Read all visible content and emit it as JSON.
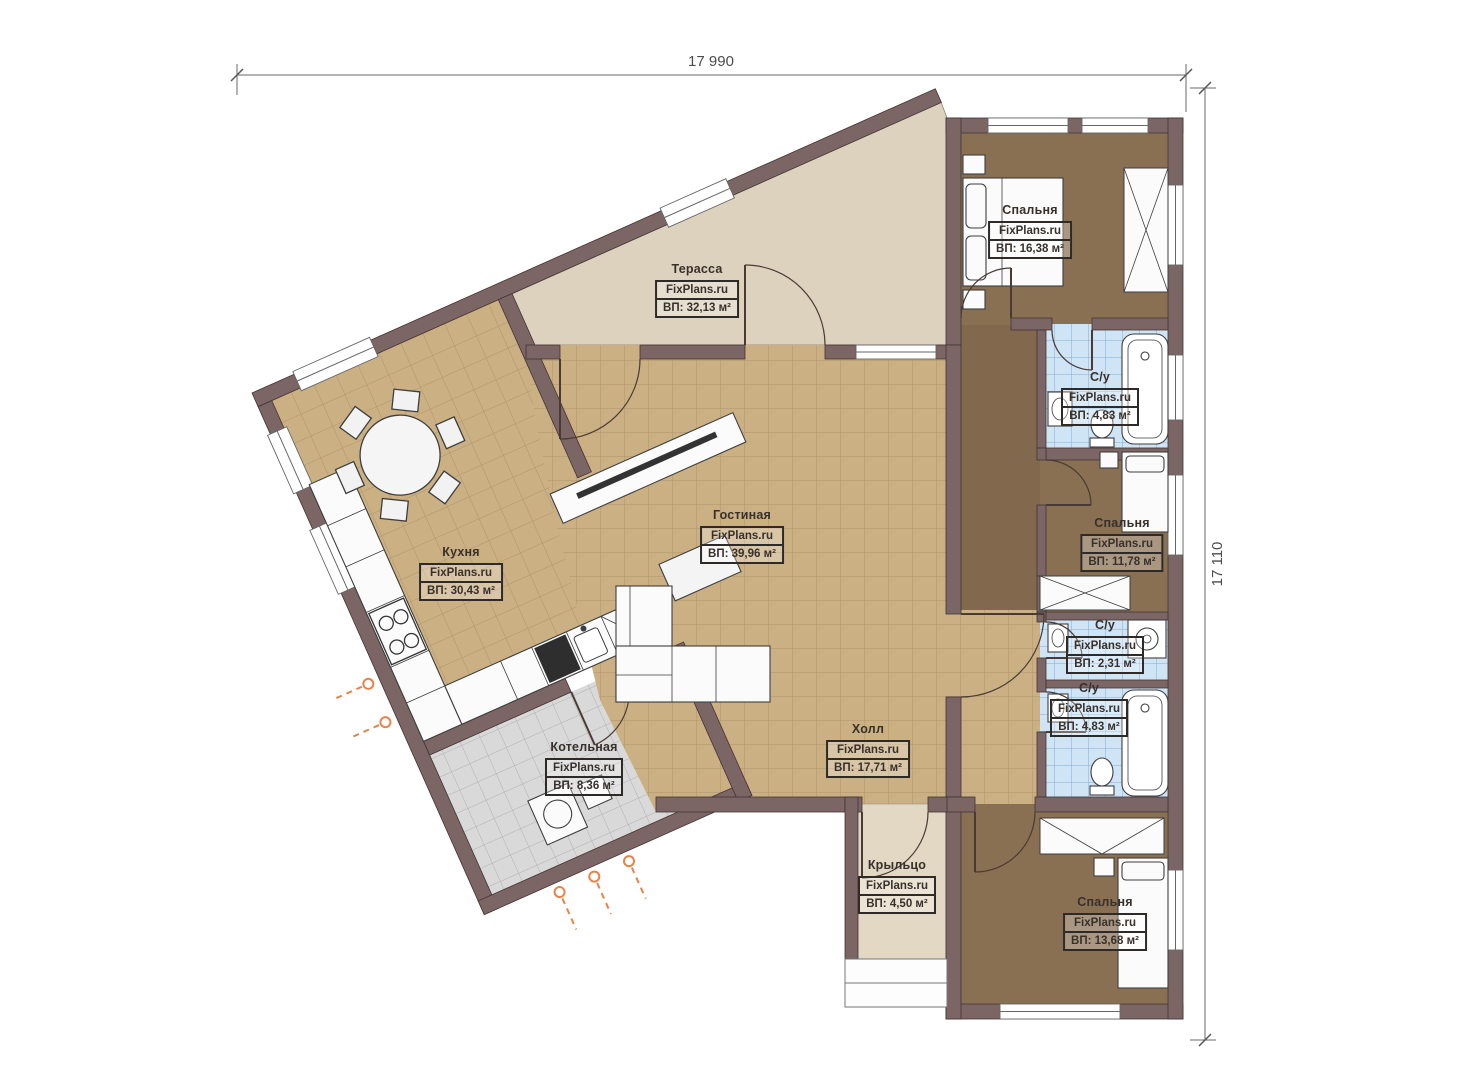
{
  "watermark": "FixPlans.ru",
  "dimensions": {
    "top": "17 990",
    "right": "17 110"
  },
  "rooms": [
    {
      "key": "terrace",
      "name": "Терасса",
      "brand": "FixPlans.ru",
      "area": "ВП: 32,13 м²"
    },
    {
      "key": "kitchen",
      "name": "Кухня",
      "brand": "FixPlans.ru",
      "area": "ВП: 30,43 м²"
    },
    {
      "key": "living-room",
      "name": "Гостиная",
      "brand": "FixPlans.ru",
      "area": "ВП: 39,96 м²"
    },
    {
      "key": "hall",
      "name": "Холл",
      "brand": "FixPlans.ru",
      "area": "ВП: 17,71 м²"
    },
    {
      "key": "boiler-room",
      "name": "Котельная",
      "brand": "FixPlans.ru",
      "area": "ВП: 8,36 м²"
    },
    {
      "key": "porch",
      "name": "Крыльцо",
      "brand": "FixPlans.ru",
      "area": "ВП: 4,50 м²"
    },
    {
      "key": "bedroom-top",
      "name": "Спальня",
      "brand": "FixPlans.ru",
      "area": "ВП: 16,38 м²"
    },
    {
      "key": "bathroom-top",
      "name": "С/у",
      "brand": "FixPlans.ru",
      "area": "ВП: 4,83 м²"
    },
    {
      "key": "bedroom-middle",
      "name": "Спальня",
      "brand": "FixPlans.ru",
      "area": "ВП: 11,78 м²"
    },
    {
      "key": "bathroom-middle",
      "name": "С/у",
      "brand": "FixPlans.ru",
      "area": "ВП: 2,31 м²"
    },
    {
      "key": "bathroom-lower",
      "name": "С/у",
      "brand": "FixPlans.ru",
      "area": "ВП: 4,83 м²"
    },
    {
      "key": "bedroom-bottom",
      "name": "Спальня",
      "brand": "FixPlans.ru",
      "area": "ВП: 13,68 м²"
    }
  ],
  "colors": {
    "wall": "#7b6565",
    "tan_floor": "#cbb084",
    "terrace_floor": "#ddd2bd",
    "bedroom_floor": "#8a7053",
    "bathroom_floor": "#cfe4f5",
    "boiler_floor": "#d9d9d9",
    "radiator_accent": "#e8824a"
  }
}
